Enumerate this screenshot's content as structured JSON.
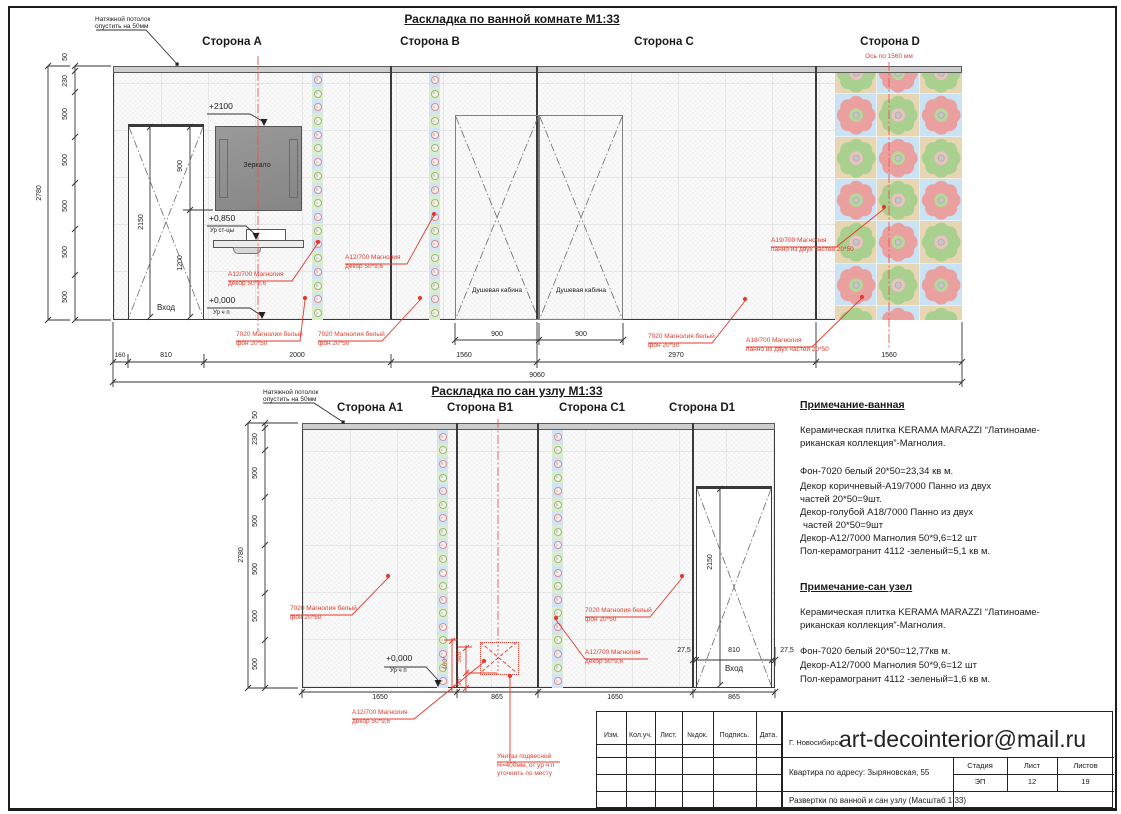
{
  "colors": {
    "red": "#e23b2e",
    "pink": "#eba0a0",
    "green": "#a9d08f",
    "blue_bg": "#c9e2f4",
    "tan_bg": "#e6d6b3",
    "strip_blue": "#cfe4f4",
    "strip_green": "#dcebcd",
    "pink_ring": "#d98f8f",
    "green_ring": "#93bd7a"
  },
  "bath": {
    "title": "Раскладка по ванной комнате М1:33",
    "sides": [
      "Сторона А",
      "Сторона В",
      "Сторона С",
      "Сторона D"
    ],
    "axis": "Ось по 1560 мм",
    "ceiling_note": [
      "Натяжной потолок",
      "опустить на 50мм"
    ],
    "entrance": "Вход",
    "mirror": "Зеркало",
    "shower": "Душевая кабина",
    "levels": {
      "l2100": "+2100",
      "l850": "+0,850",
      "l850ref": "Ур ст-цы",
      "l0": "+0,000",
      "l0ref": "Ур ч п"
    },
    "dims": {
      "v": [
        "50",
        "230",
        "500",
        "500",
        "500",
        "500",
        "500"
      ],
      "vtotal": "2780",
      "h": [
        "160",
        "810",
        "2000",
        "1560",
        "2970",
        "1560"
      ],
      "htotal": "9060",
      "shower": [
        "900",
        "900"
      ],
      "door": "2150",
      "doorsegs": [
        "900",
        "1200"
      ]
    }
  },
  "wc": {
    "title": "Раскладка по сан узлу М1:33",
    "sides": [
      "Сторона А1",
      "Сторона В1",
      "Сторона С1",
      "Сторона D1"
    ],
    "ceiling_note": [
      "Натяжной потолок",
      "опустить на 50мм"
    ],
    "entrance": "Вход",
    "levels": {
      "l0": "+0,000",
      "l0ref": "Ур ч п"
    },
    "dims": {
      "v": [
        "50",
        "230",
        "500",
        "500",
        "500",
        "500",
        "500"
      ],
      "vtotal": "2780",
      "h": [
        "1650",
        "865",
        "1650",
        "865"
      ],
      "door": "2150",
      "doorside_l": "27,5",
      "doorside_r": "27,5",
      "doorleaf": "810",
      "red": [
        "400*",
        "305*",
        "95*"
      ]
    }
  },
  "ann": {
    "a12": [
      "А12/700 Магнолия",
      "декор 50*9,6"
    ],
    "bg": [
      "7020 Магнолия белый",
      "фон 20*50"
    ],
    "p18": [
      "А18/700 Магнолия",
      "панно из двух частей 20*50"
    ],
    "p19": [
      "А19/700 Магнолия",
      "панно из двух частей 20*50"
    ],
    "toilet": [
      "Унитаз подвесной",
      "Н=400мм, от ур ч п",
      "уточнить по месту"
    ]
  },
  "notes": {
    "bath_head": "Примечание-ванная",
    "intro": [
      "Керамическая плитка KERAMA MARAZZI “Латиноаме-",
      "риканская коллекция”-Магнолия."
    ],
    "bath_lines": [
      "Фон-7020 белый 20*50=23,34  кв м.",
      "Декор коричневый-А19/7000 Панно из двух",
      "частей 20*50=9шт.",
      "Декор-голубой А18/7000 Панно из двух",
      "частей 20*50=9шт",
      "Декор-А12/7000 Магнолия 50*9,6=12 шт",
      "Пол-керамогранит 4112 -зеленый=5,1 кв м."
    ],
    "wc_head": "Примечание-сан узел",
    "wc_lines": [
      "Фон-7020 белый 20*50=12,77кв м.",
      "Декор-А12/7000 Магнолия 50*9,6=12 шт",
      "Пол-керамогранит 4112 -зеленый=1,6 кв м."
    ]
  },
  "titleblock": {
    "cols": [
      "Изм.",
      "Кол.уч.",
      "Лист.",
      "№док.",
      "Подпись.",
      "Дата."
    ],
    "city": "Г. Новосибирск",
    "email": "art-decointerior@mail.ru",
    "address": "Квартира по адресу: Зыряновская, 55",
    "doc": "Развертки по ванной и сан узлу (Масштаб 1:33)",
    "meta_heads": [
      "Стадия",
      "Лист",
      "Листов"
    ],
    "meta_vals": [
      "ЭП",
      "12",
      "19"
    ]
  }
}
